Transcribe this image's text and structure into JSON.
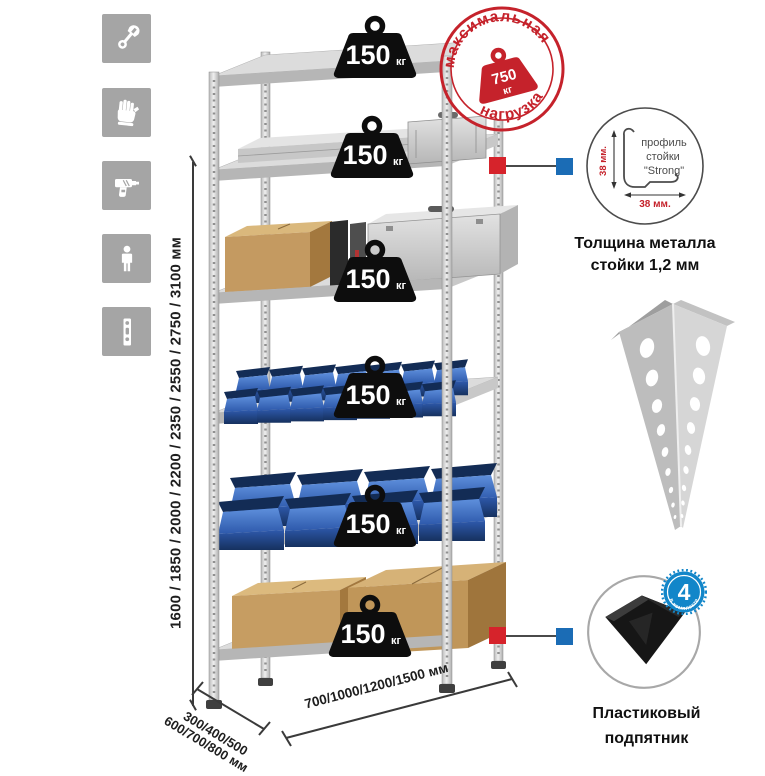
{
  "page": {
    "background": "#ffffff"
  },
  "sidebar": {
    "tile_color": "#a5a5a5",
    "icons": [
      {
        "name": "wrench-icon"
      },
      {
        "name": "gloves-icon"
      },
      {
        "name": "drill-icon"
      },
      {
        "name": "person-icon"
      },
      {
        "name": "perforated-post-icon"
      }
    ]
  },
  "stamp": {
    "arc_top": "максимальная",
    "arc_bottom": "нагрузка",
    "value": "750",
    "unit": "кг",
    "color": "#c5222b"
  },
  "rack": {
    "shelf_count": 6,
    "load_value": "150",
    "load_unit": "кг"
  },
  "dimensions": {
    "height": "1600 / 1850 / 2000 / 2200 / 2350 / 2550 / 2750 / 3100 мм",
    "depth_line1": "300/400/500",
    "depth_line2": "600/700/800 мм",
    "width": "700/1000/1200/1500 мм"
  },
  "profile_detail": {
    "label_line1": "профиль",
    "label_line2": "стойки",
    "label_line3": "\"Strong\"",
    "dim_vertical": "38 мм.",
    "dim_horizontal": "38 мм.",
    "caption_line1": "Толщина металла",
    "caption_line2": "стойки 1,2 мм"
  },
  "foot_detail": {
    "badge_value": "4",
    "badge_label": "в комплекте",
    "badge_color": "#1286c9",
    "caption_line1": "Пластиковый",
    "caption_line2": "подпятник"
  },
  "connectors": {
    "red": "#d6232b",
    "blue": "#1b6cb5"
  }
}
